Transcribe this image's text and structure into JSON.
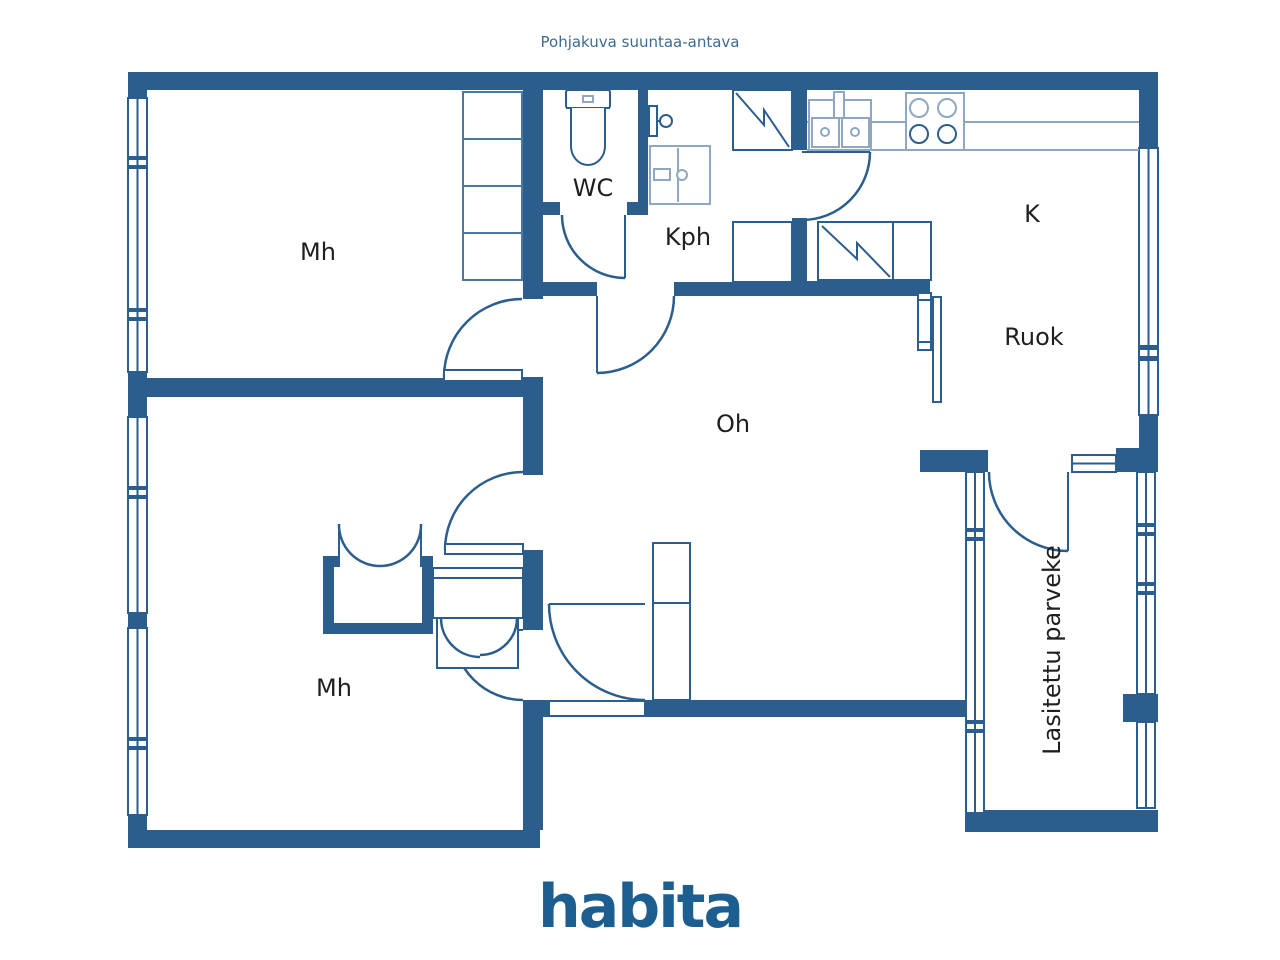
{
  "title": "Pohjakuva suuntaa-antava",
  "logo": {
    "text": "habita"
  },
  "colors": {
    "wall": "#2b5e8c",
    "mid": "#4a78a2",
    "light": "#90a8bf",
    "label": "#1f1f1f",
    "title": "#3b6b94",
    "logo": "#1d5e90"
  },
  "rooms": [
    {
      "id": "mh-top",
      "label": "Mh"
    },
    {
      "id": "wc",
      "label": "WC"
    },
    {
      "id": "kph",
      "label": "Kph"
    },
    {
      "id": "kitchen",
      "label": "K"
    },
    {
      "id": "dining",
      "label": "Ruok"
    },
    {
      "id": "living",
      "label": "Oh"
    },
    {
      "id": "mh-bottom",
      "label": "Mh"
    },
    {
      "id": "balcony",
      "label": "Lasitettu parveke"
    }
  ]
}
